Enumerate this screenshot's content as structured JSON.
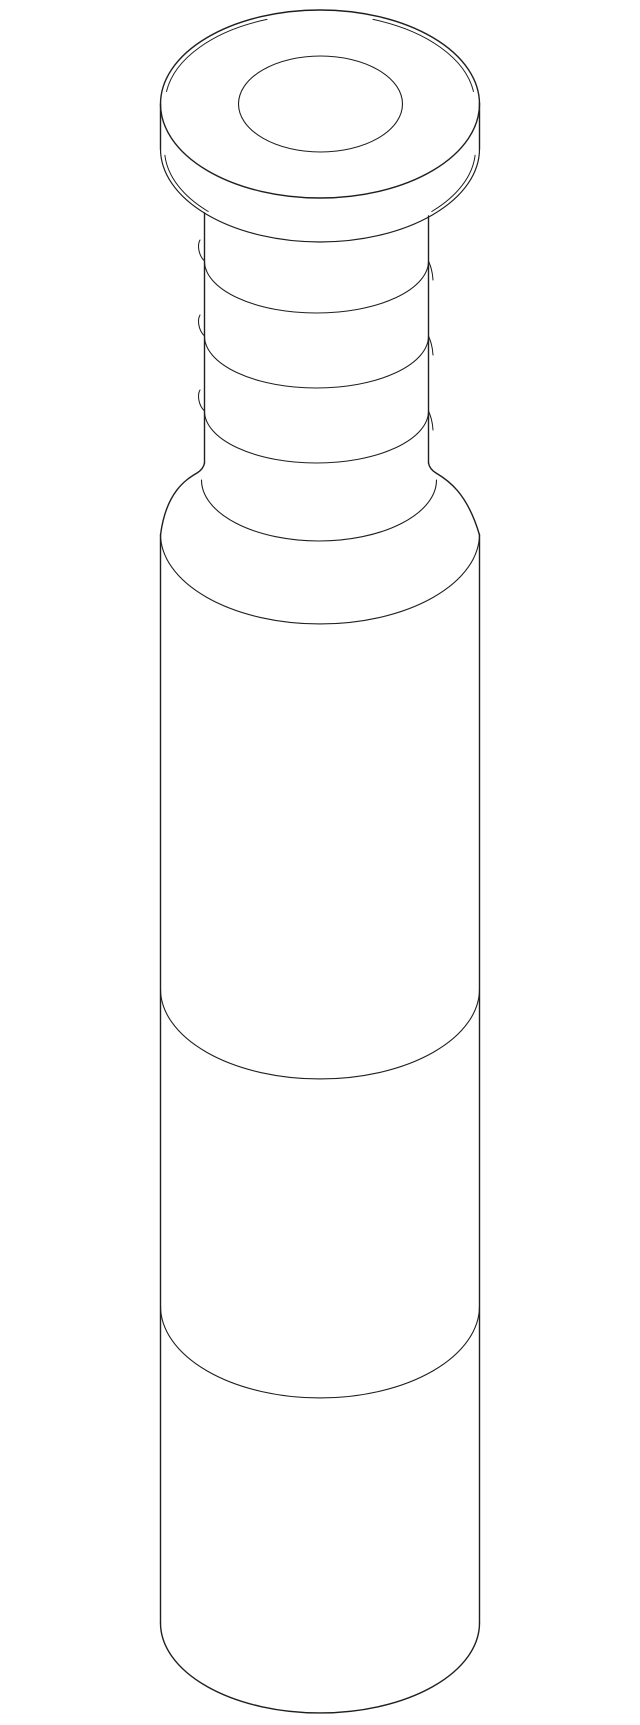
{
  "canvas": {
    "width": 640,
    "height": 1725,
    "background": "#ffffff"
  },
  "drawing": {
    "kind": "isometric-technical-line-drawing",
    "subject": "flanged cylindrical pin/bushing with round head, center hole, threaded neck and long cylindrical body",
    "stroke_color": "#1f1f1f",
    "stroke_width": 1.25,
    "parts_shown": [
      "round flange head with center hole",
      "flange side wall with chamfered top and bottom rims",
      "threaded neck with three helix turns",
      "filleted shoulder flare",
      "large cylindrical body with two circumferential seam lines",
      "flat bottom with front rim arc"
    ],
    "shapes": [
      {
        "name": "flange-top-outer-rim",
        "type": "ellipse",
        "cx": 320,
        "cy": 104,
        "rx": 159.5,
        "ry": 94,
        "w": 1.4
      },
      {
        "name": "flange-top-chamfer-left",
        "type": "path",
        "d": "M 166.5 91.5 A 155 90 0 0 1 267 19.4",
        "w": 1.0
      },
      {
        "name": "flange-top-chamfer-right",
        "type": "path",
        "d": "M 373 19.4 A 155 90 0 0 1 473.5 91.5",
        "w": 1.0
      },
      {
        "name": "flange-center-hole",
        "type": "ellipse",
        "cx": 320.5,
        "cy": 104,
        "rx": 82,
        "ry": 48,
        "w": 1.1
      },
      {
        "name": "flange-side-wall-left",
        "type": "line",
        "x1": 160.5,
        "y1": 104,
        "x2": 160.5,
        "y2": 149,
        "w": 1.4
      },
      {
        "name": "flange-side-wall-right",
        "type": "line",
        "x1": 479.5,
        "y1": 103,
        "x2": 479.5,
        "y2": 149,
        "w": 1.4
      },
      {
        "name": "flange-bottom-rim",
        "type": "path",
        "d": "M 160.5 149 A 159.5 93 0 0 0 479.5 149",
        "w": 1.2
      },
      {
        "name": "flange-bottom-chamfer-left",
        "type": "path",
        "d": "M 164.9 155.3 A 155.5 90 0 0 0 208.2 211.5",
        "w": 1.0
      },
      {
        "name": "flange-bottom-chamfer-right",
        "type": "path",
        "d": "M 475.1 155.3 A 155.5 90 0 0 1 431.8 211.5",
        "w": 1.0
      },
      {
        "name": "neck-silhouette-left",
        "type": "line",
        "x1": 204.5,
        "y1": 213,
        "x2": 204.5,
        "y2": 463,
        "w": 1.4
      },
      {
        "name": "neck-silhouette-right",
        "type": "line",
        "x1": 428.5,
        "y1": 216,
        "x2": 428.5,
        "y2": 463,
        "w": 1.4
      },
      {
        "name": "thread-turn-1",
        "type": "path",
        "d": "M 200 240 C 197.2 245 198.3 255 204.5 261 A 112 52 0 0 0 428.5 261 C 430.5 266 432.5 271 433 280",
        "w": 1.05
      },
      {
        "name": "thread-turn-2",
        "type": "path",
        "d": "M 200 315 C 197.2 320 198.3 330 204.5 336 A 112 52 0 0 0 428.5 336 C 430.5 341 432.5 346 433 355",
        "w": 1.05
      },
      {
        "name": "thread-turn-3",
        "type": "path",
        "d": "M 200 390 C 197.2 395 198.3 405 204.5 411 A 112 52 0 0 0 428.5 411 C 430.5 416 432.5 421 433 430",
        "w": 1.05
      },
      {
        "name": "shoulder-silhouette-left",
        "type": "path",
        "d": "M 204.5 463 Q 203.5 469 197 473 C 186 479.5 166 492 160.5 535",
        "w": 1.4
      },
      {
        "name": "shoulder-silhouette-right",
        "type": "path",
        "d": "M 428.5 463 Q 429.5 469 436 473 C 447 479.5 467 492 479.5 535",
        "w": 1.4
      },
      {
        "name": "shoulder-crease-arc",
        "type": "path",
        "d": "M 201.5 480 A 117.5 61 0 0 0 436.5 480",
        "w": 1.1
      },
      {
        "name": "body-top-rim-arc",
        "type": "path",
        "d": "M 160.5 534 A 159.5 90 0 0 0 479.5 534",
        "w": 1.1
      },
      {
        "name": "body-silhouette-left",
        "type": "line",
        "x1": 160.5,
        "y1": 535,
        "x2": 160.5,
        "y2": 1623,
        "w": 1.4
      },
      {
        "name": "body-silhouette-right",
        "type": "line",
        "x1": 479.5,
        "y1": 535,
        "x2": 479.5,
        "y2": 1623,
        "w": 1.4
      },
      {
        "name": "body-seam-upper-arc",
        "type": "path",
        "d": "M 160.5 989 A 159.5 90 0 0 0 479.5 989",
        "w": 1.1
      },
      {
        "name": "body-seam-lower-arc",
        "type": "path",
        "d": "M 160.5 1306 A 159.5 92 0 0 0 479.5 1306",
        "w": 1.1
      },
      {
        "name": "body-bottom-rim-arc",
        "type": "path",
        "d": "M 160.5 1623 A 159.5 90 0 0 0 479.5 1623",
        "w": 1.4
      }
    ]
  }
}
